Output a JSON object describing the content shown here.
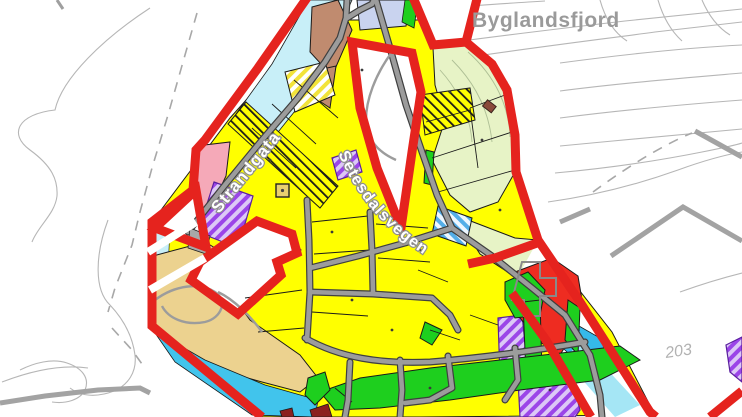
{
  "map": {
    "labels": {
      "place": "Byglandsfjord",
      "road_primary": "Strandgata",
      "road_secondary": "Setesdalsvegen",
      "elevation": "203"
    },
    "colors": {
      "plan_boundary_red": "#e5231e",
      "residential_yellow": "#ffff00",
      "pale_green_area": "#e7f3c6",
      "bright_green_area": "#1ecf1e",
      "tan_beach_area": "#ecd28f",
      "water_light": "#c8eff8",
      "water_medium": "#41c4ec",
      "lavender_zone": "#c9d3ef",
      "brown_zone": "#c08b6f",
      "pink_zone": "#f5a9b8",
      "purple_zone_stripe": "#9b45e8",
      "red_zone": "#ee2c21",
      "maroon_zone": "#8b2020",
      "blue_stripe_zone": "#54aee8",
      "road_gray": "#9c9c9c",
      "road_casing": "#3f3f3f",
      "contour_gray": "#b6b6b6",
      "label_gray": "#9a9a9a"
    }
  }
}
